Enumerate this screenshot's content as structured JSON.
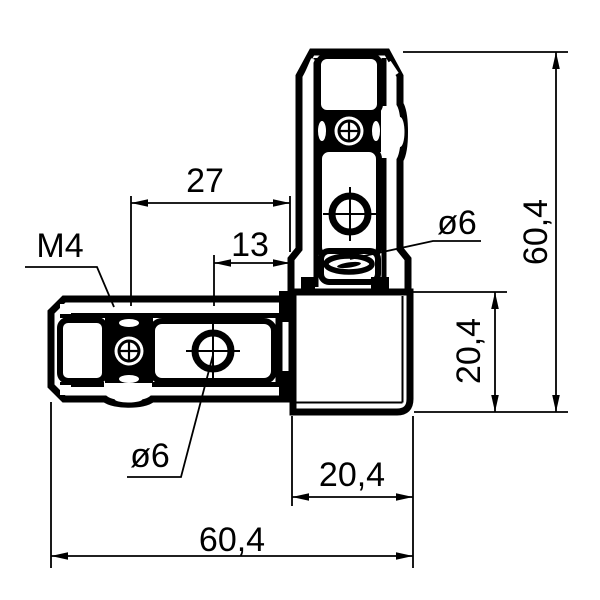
{
  "drawing": {
    "kind": "engineering-dimension-drawing",
    "part_name": "L corner connector, end view of two 20x20 profiles joined by corner cube",
    "colors": {
      "background": "#ffffff",
      "ink": "#000000"
    },
    "labels": {
      "dim_27": "27",
      "dim_13": "13",
      "thread": "M4",
      "dia_top": "ø6",
      "dia_bottom": "ø6",
      "overall_height": "60,4",
      "block_height": "20,4",
      "block_width": "20,4",
      "overall_width": "60,4"
    }
  }
}
